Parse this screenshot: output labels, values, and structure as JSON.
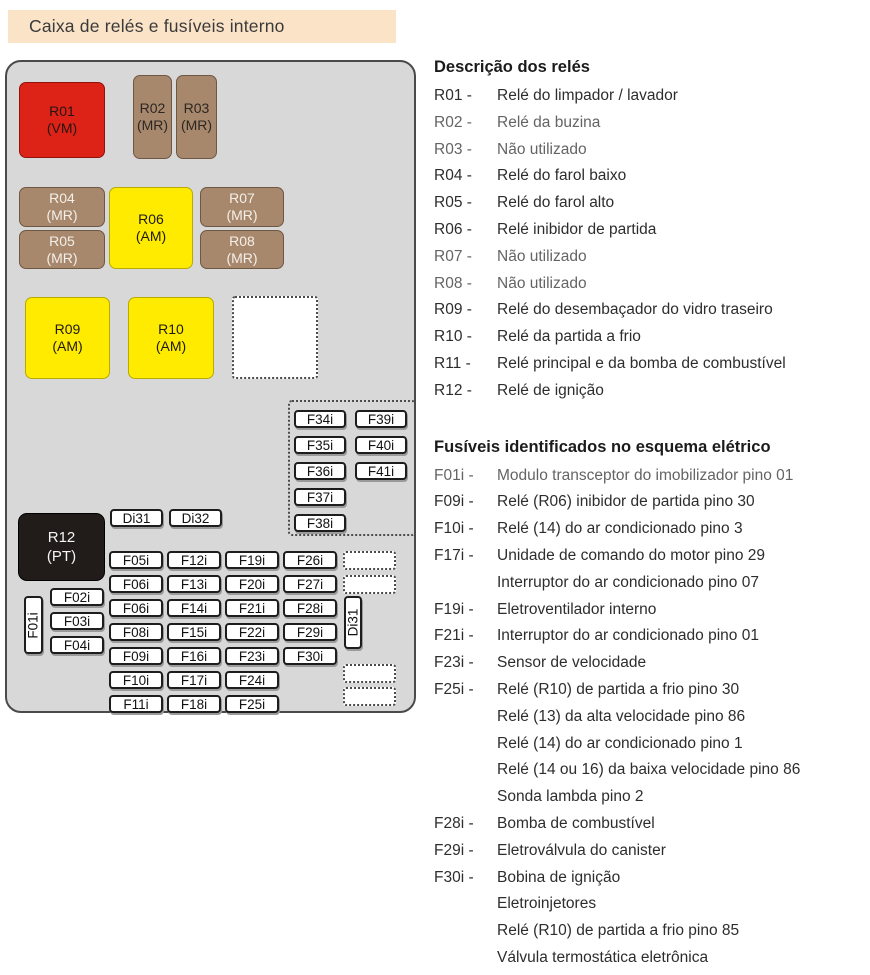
{
  "title": "Caixa de relés e fusíveis interno",
  "colors": {
    "title_bg": "#fbe3c7",
    "box_bg": "#d8d8d8",
    "relay_red": "#dd2317",
    "relay_brown": "#a8886c",
    "relay_yellow": "#ffeb00",
    "relay_black": "#211c19"
  },
  "diagram": {
    "relays": [
      {
        "id": "R01",
        "code": "(VM)"
      },
      {
        "id": "R02",
        "code": "(MR)"
      },
      {
        "id": "R03",
        "code": "(MR)"
      },
      {
        "id": "R04",
        "code": "(MR)"
      },
      {
        "id": "R05",
        "code": "(MR)"
      },
      {
        "id": "R06",
        "code": "(AM)"
      },
      {
        "id": "R07",
        "code": "(MR)"
      },
      {
        "id": "R08",
        "code": "(MR)"
      },
      {
        "id": "R09",
        "code": "(AM)"
      },
      {
        "id": "R10",
        "code": "(AM)"
      },
      {
        "id": "R12",
        "code": "(PT)"
      }
    ],
    "diodes_top": [
      "Di31",
      "Di32"
    ],
    "diode_vertical": "Di31",
    "side_fuse_vertical": "F01i",
    "left_fuses": [
      "F02i",
      "F03i",
      "F04i"
    ],
    "grid_rows": [
      [
        "F05i",
        "F12i",
        "F19i",
        "F26i"
      ],
      [
        "F06i",
        "F13i",
        "F20i",
        "F27i"
      ],
      [
        "F06i",
        "F14i",
        "F21i",
        "F28i"
      ],
      [
        "F08i",
        "F15i",
        "F22i",
        "F29i"
      ],
      [
        "F09i",
        "F16i",
        "F23i",
        "F30i"
      ],
      [
        "F10i",
        "F17i",
        "F24i"
      ],
      [
        "F11i",
        "F18i",
        "F25i"
      ]
    ],
    "dashed_group_rows": [
      [
        "F34i",
        "F39i"
      ],
      [
        "F35i",
        "F40i"
      ],
      [
        "F36i",
        "F41i"
      ],
      [
        "F37i"
      ],
      [
        "F38i"
      ]
    ]
  },
  "relay_section": {
    "heading": "Descrição dos relés",
    "items": [
      {
        "label": "R01 -",
        "lines": [
          "Relé do limpador / lavador"
        ],
        "faded": false
      },
      {
        "label": "R02 -",
        "lines": [
          "Relé da buzina"
        ],
        "faded": true
      },
      {
        "label": "R03 -",
        "lines": [
          "Não utilizado"
        ],
        "faded": true
      },
      {
        "label": "R04 -",
        "lines": [
          "Relé do farol baixo"
        ],
        "faded": false
      },
      {
        "label": "R05 -",
        "lines": [
          "Relé do farol alto"
        ],
        "faded": false
      },
      {
        "label": "R06 -",
        "lines": [
          "Relé inibidor de partida"
        ],
        "faded": false
      },
      {
        "label": "R07 -",
        "lines": [
          "Não utilizado"
        ],
        "faded": true
      },
      {
        "label": "R08 -",
        "lines": [
          "Não utilizado"
        ],
        "faded": true
      },
      {
        "label": "R09 -",
        "lines": [
          "Relé do desembaçador do vidro traseiro"
        ],
        "faded": false
      },
      {
        "label": "R10 -",
        "lines": [
          "Relé da partida a frio"
        ],
        "faded": false
      },
      {
        "label": "R11 -",
        "lines": [
          "Relé principal e da bomba de combustível"
        ],
        "faded": false
      },
      {
        "label": "R12 -",
        "lines": [
          "Relé de ignição"
        ],
        "faded": false
      }
    ]
  },
  "fuse_section": {
    "heading": "Fusíveis identificados no esquema elétrico",
    "items": [
      {
        "label": "F01i -",
        "lines": [
          "Modulo transceptor do imobilizador pino 01"
        ],
        "faded": true
      },
      {
        "label": "F09i -",
        "lines": [
          "Relé (R06) inibidor de partida pino 30"
        ],
        "faded": false
      },
      {
        "label": "F10i -",
        "lines": [
          "Relé (14) do ar condicionado pino 3"
        ],
        "faded": false
      },
      {
        "label": "F17i -",
        "lines": [
          "Unidade de comando do motor pino 29",
          "Interruptor do ar condicionado pino 07"
        ],
        "faded": false
      },
      {
        "label": "F19i -",
        "lines": [
          "Eletroventilador interno"
        ],
        "faded": false
      },
      {
        "label": "F21i -",
        "lines": [
          "Interruptor do ar condicionado pino 01"
        ],
        "faded": false
      },
      {
        "label": "F23i -",
        "lines": [
          "Sensor de velocidade"
        ],
        "faded": false
      },
      {
        "label": "F25i -",
        "lines": [
          "Relé (R10) de partida a frio pino 30",
          "Relé (13) da alta velocidade pino 86",
          "Relé (14) do ar condicionado pino 1",
          "Relé (14 ou 16) da baixa velocidade pino 86",
          "Sonda lambda pino 2"
        ],
        "faded": false
      },
      {
        "label": "F28i -",
        "lines": [
          "Bomba de combustível"
        ],
        "faded": false
      },
      {
        "label": "F29i -",
        "lines": [
          "Eletroválvula do canister"
        ],
        "faded": false
      },
      {
        "label": "F30i -",
        "lines": [
          "Bobina de ignição",
          "Eletroinjetores",
          "Relé (R10) de partida a frio pino 85",
          "Válvula termostática eletrônica"
        ],
        "faded": false
      }
    ]
  }
}
